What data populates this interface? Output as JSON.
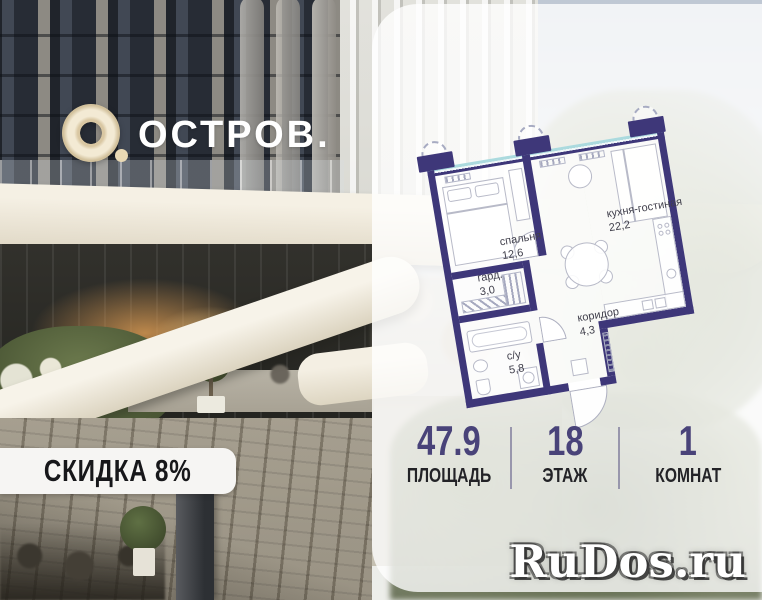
{
  "brand": {
    "mark_period": ".",
    "name": "ОСТРОВ."
  },
  "plan": {
    "rooms": {
      "kitchen": {
        "name": "кухня-гостиная",
        "area": "22,2"
      },
      "bedroom": {
        "name": "спальня",
        "area": "12,6"
      },
      "wardrobe": {
        "name": "гард.",
        "area": "3,0"
      },
      "bathroom": {
        "name": "с/у",
        "area": "5,8"
      },
      "corridor": {
        "name": "коридор",
        "area": "4,3"
      }
    },
    "colors": {
      "wall": "#3e3779",
      "glazing": "#abdade",
      "furniture_stroke": "#b8bac8"
    }
  },
  "stats": {
    "area": {
      "value": "47.9",
      "label": "ПЛОЩАДЬ"
    },
    "floor": {
      "value": "18",
      "label": "ЭТАЖ"
    },
    "rooms": {
      "value": "1",
      "label": "КОМНАТ"
    }
  },
  "badge": {
    "label": "СКИДКА 8%"
  },
  "watermark": {
    "label": "RuDos.ru"
  },
  "colors": {
    "accent_number": "#494379",
    "label_text": "#232327",
    "badge_bg": "#f6f5f3"
  }
}
